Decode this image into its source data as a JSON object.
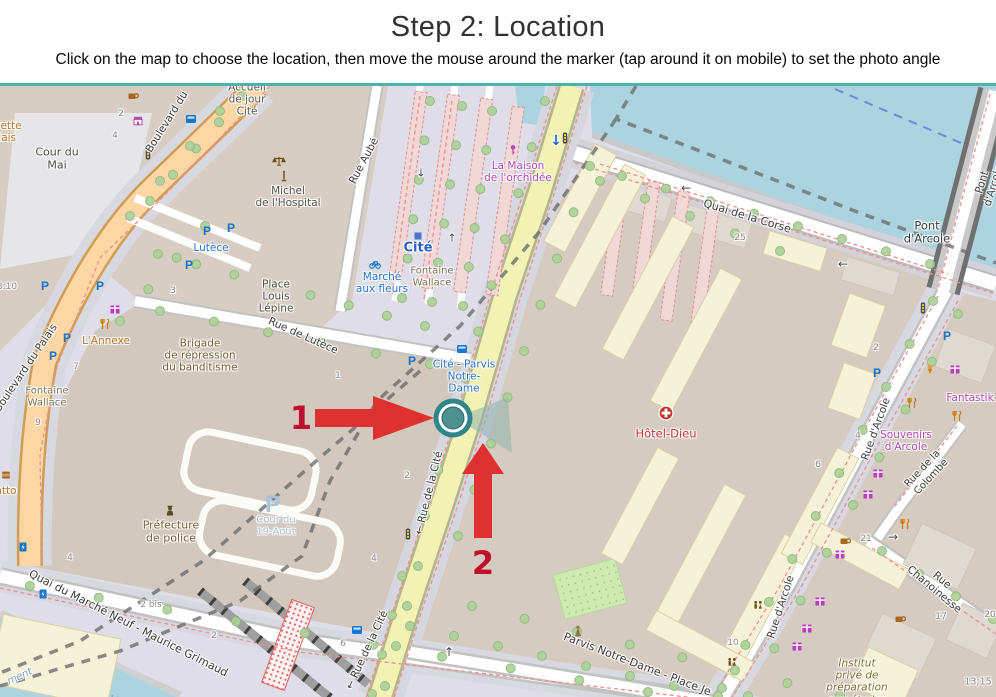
{
  "header": {
    "title": "Step 2: Location",
    "subtitle": "Click on the map to choose the location, then move the mouse around the marker (tap around it on mobile) to set the photo angle"
  },
  "annotations": {
    "step1": "1",
    "step2": "2"
  },
  "colors": {
    "divider_teal": "#4eb3a8",
    "arrow_red": "#e03131",
    "number_red": "#c00f2e",
    "marker_ring": "#2e8689",
    "marker_fill": "#4e9090",
    "water": "#abd4e0",
    "road_primary": "#fcd6a4",
    "road_secondary": "#f1f2b4",
    "building_tan": "#d7cdc3",
    "pedestrian": "#dedde8",
    "hospital_building": "#f6f2d8",
    "transit_blue": "#2b74c8",
    "shop_magenta": "#b14ab1",
    "poi_brown": "#7a6036"
  },
  "map": {
    "labels": [
      {
        "t": "Accueil\nde jour\nCité",
        "x": 247,
        "y": 14,
        "c": "#5a5a52",
        "s": 10.5,
        "n": "poi-accueil-de-jour-cite"
      },
      {
        "t": "Buvette\nPalais",
        "x": 1,
        "y": 46,
        "c": "#b8742a",
        "s": 10.5,
        "n": "poi-buvette-palais"
      },
      {
        "t": "Cour du\nMai",
        "x": 57,
        "y": 73,
        "c": "#4d4d45",
        "s": 11,
        "n": "place-cour-du-mai"
      },
      {
        "t": "Boulevard du",
        "x": 167,
        "y": 36,
        "r": -58,
        "s": 10.5,
        "n": "street-boulevard-du-palais-top"
      },
      {
        "t": "Boulevard du Palais",
        "x": 26,
        "y": 282,
        "r": -56,
        "s": 10.5,
        "n": "street-boulevard-du-palais"
      },
      {
        "t": "Michel\nde l'Hospital",
        "x": 288,
        "y": 111,
        "c": "#56564a",
        "s": 10.5,
        "n": "poi-michel-de-lhospital"
      },
      {
        "t": "Rue Aubé",
        "x": 364,
        "y": 75,
        "r": -62,
        "s": 10.5,
        "n": "street-rue-aube"
      },
      {
        "t": "Cité",
        "x": 418,
        "y": 162,
        "c": "#2b62c0",
        "s": 13,
        "b": 1,
        "n": "station-cite"
      },
      {
        "t": "Marché\naux fleurs",
        "x": 382,
        "y": 197,
        "c": "#2b74c8",
        "s": 10.5,
        "n": "poi-marche-aux-fleurs"
      },
      {
        "t": "Fontaine\nWallace",
        "x": 432,
        "y": 191,
        "c": "#7d7455",
        "s": 10,
        "n": "poi-fontaine-wallace-2"
      },
      {
        "t": "La Maison\nde l'orchidée",
        "x": 518,
        "y": 86,
        "c": "#b14ab1",
        "s": 10.5,
        "n": "poi-la-maison-de-lorchidee"
      },
      {
        "t": "Lutèce",
        "x": 211,
        "y": 162,
        "c": "#2b74c8",
        "s": 10.5,
        "n": "poi-lutece"
      },
      {
        "t": "Place\nLouis\nLépine",
        "x": 276,
        "y": 211,
        "c": "#4d4d45",
        "s": 10.5,
        "n": "place-louis-lepine"
      },
      {
        "t": "Rue de Lutèce",
        "x": 303,
        "y": 250,
        "r": 24,
        "s": 10.5,
        "n": "street-rue-de-lutece"
      },
      {
        "t": "L'Annexe",
        "x": 106,
        "y": 255,
        "c": "#b8742a",
        "s": 10.5,
        "n": "poi-lannexe"
      },
      {
        "t": "Brigade\nde répression\ndu banditisme",
        "x": 200,
        "y": 270,
        "c": "#7a6036",
        "s": 10.5,
        "n": "poi-brigade-banditisme"
      },
      {
        "t": "Fontaine\nWallace",
        "x": 47,
        "y": 311,
        "c": "#7d7455",
        "s": 10,
        "n": "poi-fontaine-wallace-1"
      },
      {
        "t": "Quai de la Corse",
        "x": 747,
        "y": 131,
        "r": 17,
        "s": 11,
        "n": "street-quai-de-la-corse"
      },
      {
        "t": "Pont d'Arcole",
        "x": 927,
        "y": 147,
        "s": 11.5,
        "n": "street-pont-darcole"
      },
      {
        "t": "Pont d'Arcole",
        "x": 988,
        "y": 98,
        "r": -73,
        "s": 10.5,
        "n": "street-pont-darcole-rot"
      },
      {
        "t": "Cité - Parvis\nNotre-\nDame",
        "x": 464,
        "y": 291,
        "c": "#2b74c8",
        "s": 10.5,
        "n": "stop-cite-parvis-notre-dame"
      },
      {
        "t": "← Rue de la Cité",
        "x": 429,
        "y": 407,
        "r": -76,
        "s": 10.5,
        "n": "street-rue-de-la-cite-mid"
      },
      {
        "t": "← Rue de la Cité",
        "x": 367,
        "y": 564,
        "r": -65,
        "s": 10.5,
        "n": "street-rue-de-la-cite-bottom"
      },
      {
        "t": "Hôtel-Dieu",
        "x": 666,
        "y": 348,
        "c": "#c63535",
        "s": 11.5,
        "n": "poi-hotel-dieu"
      },
      {
        "t": "Préfecture\nde police",
        "x": 171,
        "y": 446,
        "c": "#7a6036",
        "s": 11,
        "n": "poi-prefecture-de-police"
      },
      {
        "t": "Cour du\n19-Août",
        "x": 276,
        "y": 440,
        "c": "#a9c0d8",
        "s": 10,
        "n": "place-cour-du-19-aout"
      },
      {
        "t": "Quai du Marché Neuf - Maurice Grimaud",
        "x": 128,
        "y": 538,
        "r": 27,
        "s": 11,
        "n": "street-quai-du-marche-neuf"
      },
      {
        "t": "atto",
        "x": 6,
        "y": 405,
        "c": "#b8742a",
        "s": 10.5,
        "n": "poi-atto"
      },
      {
        "t": "ment",
        "x": 20,
        "y": 591,
        "r": -25,
        "c": "#7d9ec0",
        "s": 10,
        "i": 1,
        "n": "label-ment"
      },
      {
        "t": "Parvis Notre-Dame - Place Je",
        "x": 637,
        "y": 579,
        "r": 21,
        "s": 11,
        "n": "street-parvis-notre-dame"
      },
      {
        "t": "Fantastik",
        "x": 970,
        "y": 312,
        "c": "#b14ab1",
        "s": 10.5,
        "n": "poi-fantastik"
      },
      {
        "t": "Souvenirs\nd'Arcole",
        "x": 906,
        "y": 355,
        "c": "#b14ab1",
        "s": 10.5,
        "n": "poi-souvenirs-darcole"
      },
      {
        "t": "Rue d'Arcole",
        "x": 876,
        "y": 343,
        "r": -70,
        "s": 10.5,
        "n": "street-rue-darcole-top"
      },
      {
        "t": "Rue d'Arcole",
        "x": 781,
        "y": 521,
        "r": -72,
        "s": 10.5,
        "n": "street-rue-darcole-bottom"
      },
      {
        "t": "Rue de la Colombe",
        "x": 927,
        "y": 387,
        "r": -47,
        "s": 10,
        "n": "street-rue-de-la-colombe"
      },
      {
        "t": "Rue Chanoinesse",
        "x": 938,
        "y": 499,
        "r": 40,
        "s": 10.5,
        "n": "street-rue-chanoinesse"
      },
      {
        "t": "Institut\nprivé de\npréparation\naux études",
        "x": 857,
        "y": 596,
        "c": "#7e7036",
        "s": 10.5,
        "i": 1,
        "n": "poi-institut-prive"
      },
      {
        "t": "13;15",
        "x": 978,
        "y": 596,
        "c": "#8d8d8d",
        "s": 9.5,
        "n": "house-number-13-15"
      },
      {
        "t": "↓",
        "x": 556,
        "y": 55,
        "c": "#2166c0",
        "s": 14,
        "b": 1,
        "n": "oneway-arrow"
      },
      {
        "t": "←",
        "x": 686,
        "y": 103,
        "c": "#4a4a4a",
        "s": 12,
        "n": "oneway-arrow"
      },
      {
        "t": "←",
        "x": 843,
        "y": 179,
        "c": "#4a4a4a",
        "s": 12,
        "n": "oneway-arrow"
      },
      {
        "t": "↑",
        "x": 449,
        "y": 567,
        "c": "#4a4a4a",
        "s": 12,
        "n": "oneway-arrow"
      },
      {
        "t": "→",
        "x": 893,
        "y": 452,
        "c": "#4a4a4a",
        "s": 12,
        "n": "oneway-arrow"
      },
      {
        "t": "↓",
        "x": 421,
        "y": 88,
        "c": "#4a4a4a",
        "s": 11,
        "n": "oneway-arrow"
      },
      {
        "t": "↑",
        "x": 452,
        "y": 153,
        "c": "#4a4a4a",
        "s": 11,
        "n": "oneway-arrow"
      }
    ],
    "house_numbers": [
      [
        "2",
        121,
        28
      ],
      [
        "4",
        115,
        50
      ],
      [
        "3",
        173,
        205
      ],
      [
        "7",
        76,
        281
      ],
      [
        "9",
        38,
        337
      ],
      [
        "1",
        338,
        290
      ],
      [
        "2",
        407,
        390
      ],
      [
        "4",
        374,
        473
      ],
      [
        "4",
        70,
        472
      ],
      [
        "2 bis",
        151,
        519
      ],
      [
        "2",
        214,
        550
      ],
      [
        "25",
        740,
        152
      ],
      [
        "6",
        818,
        379
      ],
      [
        "4",
        858,
        350
      ],
      [
        "2",
        876,
        262
      ],
      [
        "21",
        866,
        453
      ],
      [
        "17",
        941,
        531
      ],
      [
        "20",
        990,
        529
      ],
      [
        "10",
        733,
        557
      ],
      [
        "6",
        343,
        558
      ],
      [
        "8:10",
        7,
        201
      ]
    ],
    "icons": [
      [
        "scales",
        279,
        75
      ],
      [
        "monument",
        284,
        91
      ],
      [
        "store",
        138,
        35
      ],
      [
        "cafe",
        133,
        10
      ],
      [
        "flower",
        513,
        64
      ],
      [
        "bus",
        191,
        33
      ],
      [
        "bus",
        462,
        263
      ],
      [
        "bus",
        357,
        544
      ],
      [
        "metro",
        418,
        150
      ],
      [
        "bike",
        375,
        178
      ],
      [
        "parking",
        207,
        145
      ],
      [
        "parking",
        231,
        142
      ],
      [
        "parking",
        189,
        179
      ],
      [
        "parking",
        45,
        200
      ],
      [
        "parking",
        100,
        200
      ],
      [
        "parking",
        67,
        252
      ],
      [
        "parking",
        53,
        270
      ],
      [
        "parking",
        412,
        275
      ],
      [
        "parking",
        947,
        250
      ],
      [
        "parking",
        877,
        287
      ],
      [
        "parking-big",
        273,
        418
      ],
      [
        "traffic",
        148,
        68
      ],
      [
        "traffic",
        565,
        52
      ],
      [
        "traffic",
        923,
        222
      ],
      [
        "traffic",
        408,
        448
      ],
      [
        "restaurant",
        105,
        238
      ],
      [
        "restaurant",
        912,
        317
      ],
      [
        "restaurant",
        957,
        330
      ],
      [
        "restaurant",
        905,
        438
      ],
      [
        "icecream",
        930,
        283
      ],
      [
        "gift",
        115,
        223
      ],
      [
        "gift",
        955,
        283
      ],
      [
        "gift",
        878,
        387
      ],
      [
        "gift",
        868,
        408
      ],
      [
        "gift",
        840,
        468
      ],
      [
        "gift",
        820,
        515
      ],
      [
        "gift",
        807,
        542
      ],
      [
        "gift",
        797,
        560
      ],
      [
        "cafe",
        845,
        455
      ],
      [
        "cafe",
        900,
        533
      ],
      [
        "fastfood",
        6,
        389
      ],
      [
        "charging",
        23,
        461
      ],
      [
        "charging",
        43,
        508
      ],
      [
        "police",
        170,
        425
      ],
      [
        "hospital",
        666,
        327
      ],
      [
        "wc",
        758,
        520
      ],
      [
        "wc",
        732,
        577
      ],
      [
        "statue",
        578,
        545
      ]
    ]
  }
}
